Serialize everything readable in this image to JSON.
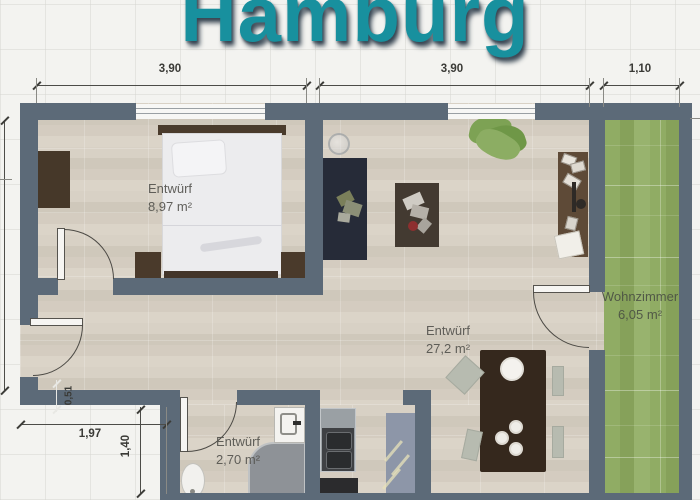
{
  "title": "Hamburg",
  "dimensions": {
    "top": [
      {
        "label": "3,90"
      },
      {
        "label": "3,90"
      },
      {
        "label": "1,10"
      }
    ],
    "notch_width": "1,97",
    "notch_height": "1,40",
    "step": "0,51"
  },
  "rooms": {
    "bedroom": {
      "label": "Entwürf",
      "area": "8,97 m²"
    },
    "living_area": {
      "label": "Entwürf",
      "area": "27,2 m²"
    },
    "bathroom": {
      "label": "Entwürf",
      "area": "2,70 m²"
    },
    "balcony": {
      "label": "Wohnzimmer",
      "area": "6,05 m²"
    }
  },
  "colors": {
    "wall": "#5c6a78",
    "floor_base": "#d5cec2",
    "balcony_green": "#8fab63",
    "title_teal": "#18909e",
    "title_shadow": "#2c3b49",
    "dimension_text": "#3a3a36",
    "room_label_text": "#55544f"
  }
}
